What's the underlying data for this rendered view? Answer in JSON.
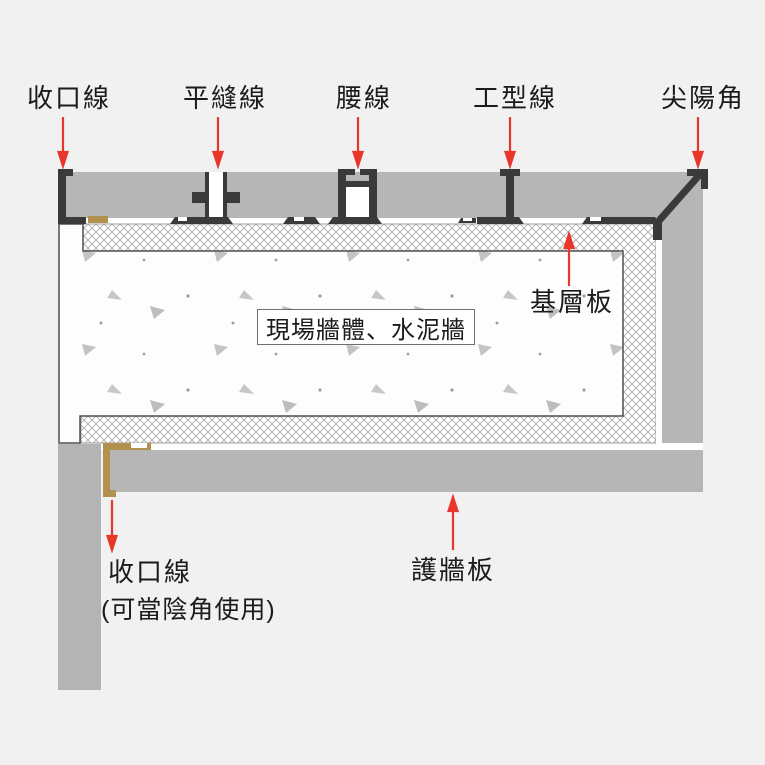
{
  "diagram": {
    "title_labels": {
      "top_left_trim": "收口線",
      "flat_seam": "平縫線",
      "waist": "腰線",
      "i_type": "工型線",
      "sharp_corner": "尖陽角"
    },
    "base_board": "基層板",
    "site_wall": "現場牆體、水泥牆",
    "bottom_trim": "收口線",
    "bottom_trim_note": "(可當陰角使用)",
    "wall_panel": "護牆板",
    "icons": {
      "callout_down": "arrow-down-icon",
      "callout_up": "arrow-up-icon"
    },
    "colors": {
      "background": "#f1f1f2",
      "panel_gray": "#b6b6b6",
      "profile_dark": "#3a3a3a",
      "trim_gold": "#b2904d",
      "arrow_red": "#e8362c",
      "concrete_white": "#fdfdfd"
    }
  }
}
